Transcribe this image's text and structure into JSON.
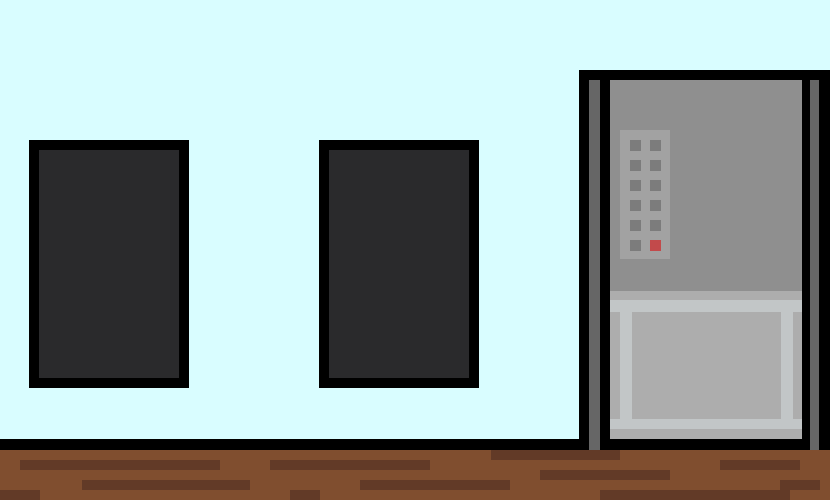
{
  "scene": {
    "description": "pixel-art room with two dark windows, wooden plank floor and a gray machine with keypad and lower door",
    "width": 830,
    "height": 500,
    "palette": {
      "wall": "#d9fdff",
      "outline": "#000000",
      "window_glass": "#2a2a2c",
      "floor": "#804e2f",
      "floor_streak": "#623a27",
      "machine_panel": "#8f8f8f",
      "machine_strip": "#666666",
      "keypad_panel": "#a2a2a2",
      "keypad_button": "#7c7c7c",
      "keypad_button_red": "#c24a4b",
      "door_base": "#adadad",
      "door_frame": "#c2c6c7"
    },
    "elements": [
      {
        "name": "wall",
        "x": 0,
        "y": 0,
        "w": 830,
        "h": 439,
        "color": "wall",
        "interactable": false
      },
      {
        "name": "floor-top-edge",
        "x": 0,
        "y": 439,
        "w": 830,
        "h": 11,
        "color": "outline",
        "interactable": false
      },
      {
        "name": "floor",
        "x": 0,
        "y": 450,
        "w": 830,
        "h": 50,
        "color": "floor",
        "interactable": false
      },
      {
        "name": "floor-plank-streak",
        "x": 491,
        "y": 450,
        "w": 129,
        "h": 10,
        "color": "floor_streak",
        "interactable": false
      },
      {
        "name": "floor-plank-streak",
        "x": 20,
        "y": 460,
        "w": 200,
        "h": 10,
        "color": "floor_streak",
        "interactable": false
      },
      {
        "name": "floor-plank-streak",
        "x": 270,
        "y": 460,
        "w": 160,
        "h": 10,
        "color": "floor_streak",
        "interactable": false
      },
      {
        "name": "floor-plank-streak",
        "x": 720,
        "y": 460,
        "w": 80,
        "h": 10,
        "color": "floor_streak",
        "interactable": false
      },
      {
        "name": "floor-plank-streak",
        "x": 540,
        "y": 470,
        "w": 130,
        "h": 10,
        "color": "floor_streak",
        "interactable": false
      },
      {
        "name": "floor-plank-streak",
        "x": 82,
        "y": 480,
        "w": 168,
        "h": 10,
        "color": "floor_streak",
        "interactable": false
      },
      {
        "name": "floor-plank-streak",
        "x": 360,
        "y": 480,
        "w": 150,
        "h": 10,
        "color": "floor_streak",
        "interactable": false
      },
      {
        "name": "floor-plank-streak",
        "x": 780,
        "y": 480,
        "w": 40,
        "h": 10,
        "color": "floor_streak",
        "interactable": false
      },
      {
        "name": "floor-plank-streak",
        "x": 0,
        "y": 490,
        "w": 40,
        "h": 10,
        "color": "floor_streak",
        "interactable": false
      },
      {
        "name": "floor-plank-streak",
        "x": 290,
        "y": 490,
        "w": 30,
        "h": 10,
        "color": "floor_streak",
        "interactable": false
      },
      {
        "name": "floor-plank-streak",
        "x": 600,
        "y": 490,
        "w": 190,
        "h": 10,
        "color": "floor_streak",
        "interactable": false
      },
      {
        "name": "window-left-frame",
        "x": 29,
        "y": 140,
        "w": 160,
        "h": 248,
        "color": "outline",
        "interactable": true
      },
      {
        "name": "window-left-glass",
        "x": 39,
        "y": 150,
        "w": 140,
        "h": 228,
        "color": "window_glass",
        "interactable": true
      },
      {
        "name": "window-right-frame",
        "x": 319,
        "y": 140,
        "w": 160,
        "h": 248,
        "color": "outline",
        "interactable": true
      },
      {
        "name": "window-right-glass",
        "x": 329,
        "y": 150,
        "w": 140,
        "h": 228,
        "color": "window_glass",
        "interactable": true
      },
      {
        "name": "machine-frame-left-outer",
        "x": 579,
        "y": 70,
        "w": 10,
        "h": 380,
        "color": "outline",
        "interactable": false
      },
      {
        "name": "machine-frame-left-strip",
        "x": 589,
        "y": 80,
        "w": 11,
        "h": 370,
        "color": "machine_strip",
        "interactable": false
      },
      {
        "name": "machine-frame-left-inner",
        "x": 600,
        "y": 80,
        "w": 10,
        "h": 370,
        "color": "outline",
        "interactable": false
      },
      {
        "name": "machine-top-bar",
        "x": 579,
        "y": 70,
        "w": 251,
        "h": 10,
        "color": "outline",
        "interactable": false
      },
      {
        "name": "machine-upper-panel",
        "x": 610,
        "y": 80,
        "w": 192,
        "h": 211,
        "color": "machine_panel",
        "interactable": false
      },
      {
        "name": "machine-lower-door",
        "x": 610,
        "y": 291,
        "w": 192,
        "h": 148,
        "color": "door_base",
        "interactable": true
      },
      {
        "name": "machine-door-frame-top",
        "x": 610,
        "y": 300,
        "w": 192,
        "h": 12,
        "color": "door_frame",
        "interactable": false
      },
      {
        "name": "machine-door-frame-left",
        "x": 620,
        "y": 300,
        "w": 12,
        "h": 129,
        "color": "door_frame",
        "interactable": false
      },
      {
        "name": "machine-door-frame-right",
        "x": 781,
        "y": 300,
        "w": 12,
        "h": 129,
        "color": "door_frame",
        "interactable": false
      },
      {
        "name": "machine-door-frame-bottom",
        "x": 610,
        "y": 419,
        "w": 192,
        "h": 10,
        "color": "door_frame",
        "interactable": false
      },
      {
        "name": "machine-frame-right-inner",
        "x": 802,
        "y": 80,
        "w": 8,
        "h": 370,
        "color": "outline",
        "interactable": false
      },
      {
        "name": "machine-frame-right-strip",
        "x": 810,
        "y": 80,
        "w": 9,
        "h": 370,
        "color": "machine_strip",
        "interactable": false
      },
      {
        "name": "machine-frame-right-outer",
        "x": 819,
        "y": 70,
        "w": 11,
        "h": 380,
        "color": "outline",
        "interactable": false
      },
      {
        "name": "keypad-panel",
        "x": 620,
        "y": 130,
        "w": 50,
        "h": 129,
        "color": "keypad_panel",
        "interactable": false
      },
      {
        "name": "keypad-button-r1c1",
        "x": 630,
        "y": 140,
        "w": 11,
        "h": 11,
        "color": "keypad_button",
        "interactable": true
      },
      {
        "name": "keypad-button-r1c2",
        "x": 650,
        "y": 140,
        "w": 11,
        "h": 11,
        "color": "keypad_button",
        "interactable": true
      },
      {
        "name": "keypad-button-r2c1",
        "x": 630,
        "y": 160,
        "w": 11,
        "h": 11,
        "color": "keypad_button",
        "interactable": true
      },
      {
        "name": "keypad-button-r2c2",
        "x": 650,
        "y": 160,
        "w": 11,
        "h": 11,
        "color": "keypad_button",
        "interactable": true
      },
      {
        "name": "keypad-button-r3c1",
        "x": 630,
        "y": 180,
        "w": 11,
        "h": 11,
        "color": "keypad_button",
        "interactable": true
      },
      {
        "name": "keypad-button-r3c2",
        "x": 650,
        "y": 180,
        "w": 11,
        "h": 11,
        "color": "keypad_button",
        "interactable": true
      },
      {
        "name": "keypad-button-r4c1",
        "x": 630,
        "y": 200,
        "w": 11,
        "h": 11,
        "color": "keypad_button",
        "interactable": true
      },
      {
        "name": "keypad-button-r4c2",
        "x": 650,
        "y": 200,
        "w": 11,
        "h": 11,
        "color": "keypad_button",
        "interactable": true
      },
      {
        "name": "keypad-button-r5c1",
        "x": 630,
        "y": 220,
        "w": 11,
        "h": 11,
        "color": "keypad_button",
        "interactable": true
      },
      {
        "name": "keypad-button-r5c2",
        "x": 650,
        "y": 220,
        "w": 11,
        "h": 11,
        "color": "keypad_button",
        "interactable": true
      },
      {
        "name": "keypad-button-r6c1",
        "x": 630,
        "y": 240,
        "w": 11,
        "h": 11,
        "color": "keypad_button",
        "interactable": true
      },
      {
        "name": "keypad-button-red",
        "x": 650,
        "y": 240,
        "w": 11,
        "h": 11,
        "color": "keypad_button_red",
        "interactable": true
      }
    ]
  }
}
